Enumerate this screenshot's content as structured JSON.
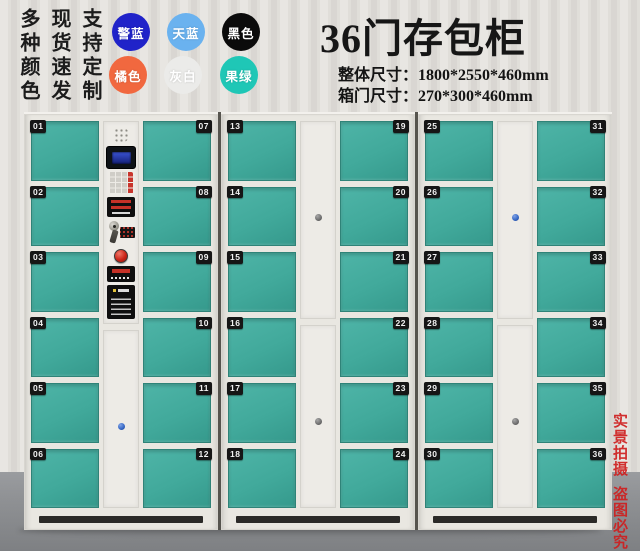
{
  "header": {
    "title": "36门存包柜",
    "spec_lines": [
      "整体尺寸：1800*2550*460mm",
      "箱门尺寸：270*300*460mm"
    ]
  },
  "promo": {
    "vertical_slogans": [
      "多种颜色",
      "现货速发",
      "支持定制"
    ],
    "swatches": [
      {
        "label": "警蓝",
        "color": "#2023c9"
      },
      {
        "label": "天蓝",
        "color": "#6ab2ef"
      },
      {
        "label": "黑色",
        "color": "#0b0b0b"
      },
      {
        "label": "橘色",
        "color": "#f1683f"
      },
      {
        "label": "灰白",
        "color": "#ebebe9"
      },
      {
        "label": "果绿",
        "color": "#1fc7b6"
      }
    ]
  },
  "watermark": {
    "lines": [
      "实景拍摄",
      "盗图必究"
    ]
  },
  "lockers": {
    "door_numbers": [
      "01",
      "02",
      "03",
      "04",
      "05",
      "06",
      "07",
      "08",
      "09",
      "10",
      "11",
      "12",
      "13",
      "14",
      "15",
      "16",
      "17",
      "18",
      "19",
      "20",
      "21",
      "22",
      "23",
      "24",
      "25",
      "26",
      "27",
      "28",
      "29",
      "30",
      "31",
      "32",
      "33",
      "34",
      "35",
      "36"
    ],
    "control_panel": {
      "components": [
        "speaker-grille",
        "lcd-display",
        "keypad",
        "card-reader-label",
        "key-lock",
        "hanging-keys",
        "mini-button-panel",
        "emergency-button",
        "swipe-area-label",
        "instruction-label"
      ]
    }
  },
  "palette": {
    "door_teal": "#41a99b",
    "door_teal_dark": "#2f8378",
    "frame_white": "#e9e7e1",
    "panel_white": "#edebe6",
    "wall_light": "#e8e6e2",
    "wall_dark": "#d9d6d2",
    "floor_gray": "#8f9194",
    "badge_black": "#161616",
    "title_black": "#161616",
    "stamp_red": "#cf1f1f",
    "lcd_blue": "#3a54d4",
    "button_red": "#c8342c",
    "lock_blue": "#3566c4",
    "lock_gray": "#6e6e6e",
    "seam_dark": "#56544e"
  }
}
